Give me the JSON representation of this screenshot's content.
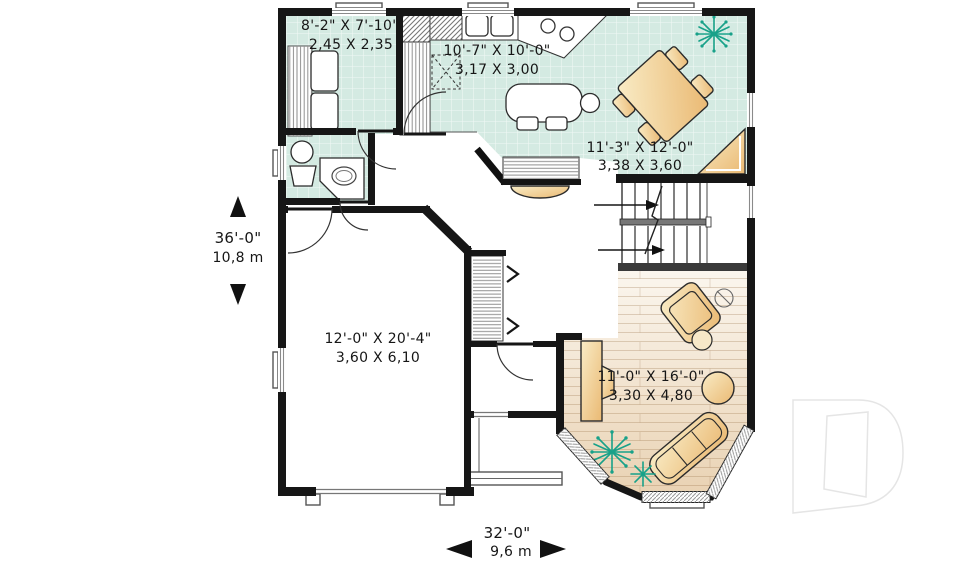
{
  "rooms": {
    "laundry": {
      "imperial": "8'-2\" X 7'-10\"",
      "metric": "2,45 X 2,35"
    },
    "kitchen": {
      "imperial": "10'-7\" X 10'-0\"",
      "metric": "3,17 X 3,00"
    },
    "dining": {
      "imperial": "11'-3\" X 12'-0\"",
      "metric": "3,38 X 3,60"
    },
    "garage": {
      "imperial": "12'-0\" X 20'-4\"",
      "metric": "3,60 X 6,10"
    },
    "living": {
      "imperial": "11'-0\" X 16'-0\"",
      "metric": "3,30 X 4,80"
    }
  },
  "overall_dimensions": {
    "depth": {
      "imperial": "36'-0\"",
      "metric": "10,8 m"
    },
    "width": {
      "imperial": "32'-0\"",
      "metric": "9,6 m"
    }
  },
  "fixtures": [
    "washer-dryer",
    "toilet",
    "vanity-sink",
    "kitchen-sink",
    "stove",
    "pantry",
    "kitchen-table",
    "dining-table",
    "corner-shelf",
    "staircase",
    "coat-closet",
    "breakfast-bar",
    "desk",
    "armchair",
    "floor-lamp",
    "side-table",
    "round-table",
    "sofa",
    "plants",
    "bay-window",
    "garage-door",
    "entry-porch"
  ],
  "colors": {
    "wall": "#161616",
    "tile": "#d4eae2",
    "wood_light": "#fbf6ee",
    "wood_dark": "#e9d2b3",
    "furniture_light": "#f9ecc6",
    "furniture_dark": "#eab973",
    "plant": "#18a189",
    "text": "#161616",
    "logo": "#e5e5e5"
  }
}
